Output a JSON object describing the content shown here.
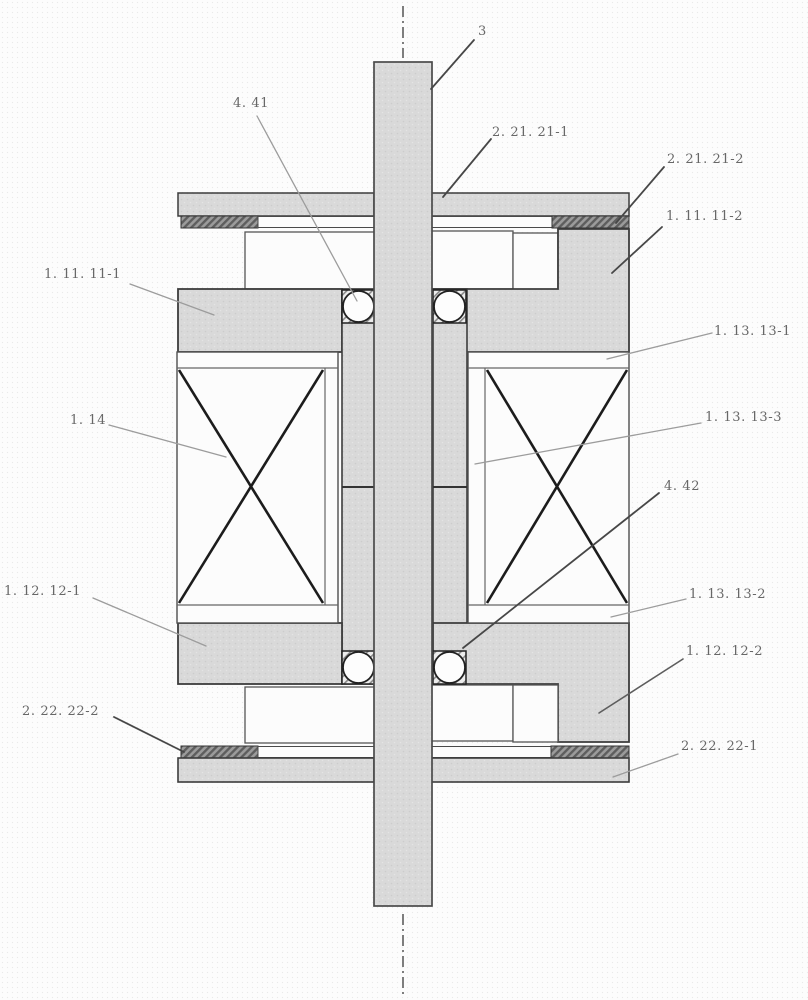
{
  "figure": {
    "kind": "patent cross-section drawing of shaft, bearing and coil assembly",
    "colors": {
      "paper": "#fcfcfc",
      "part_fill": "#d9d9d9",
      "part_stroke": "#3c3c3c",
      "hatch_dark_strip": "#7a7a7a",
      "white_part": "#fcfcfc",
      "coil_x_stroke": "#1c1c1c",
      "label_text": "#676767",
      "leader_dark": "#474747",
      "leader_light": "#9c9c9c",
      "centerline": "#555555"
    },
    "labels": {
      "shaft": "3",
      "ring_21_1": "2. 21. 21-1",
      "ring_21_2": "2. 21. 21-2",
      "block_11_2": "1. 11. 11-2",
      "block_11_1": "1. 11. 11-1",
      "ball_41": "4. 41",
      "bar_13_1": "1. 13. 13-1",
      "strip_13_3": "1. 13. 13-3",
      "coil_14": "1. 14",
      "ball_42": "4. 42",
      "block_12_1": "1. 12. 12-1",
      "bar_13_2": "1. 13. 13-2",
      "block_12_2": "1. 12. 12-2",
      "ring_22_2": "2. 22. 22-2",
      "ring_22_1": "2. 22. 22-1"
    }
  }
}
